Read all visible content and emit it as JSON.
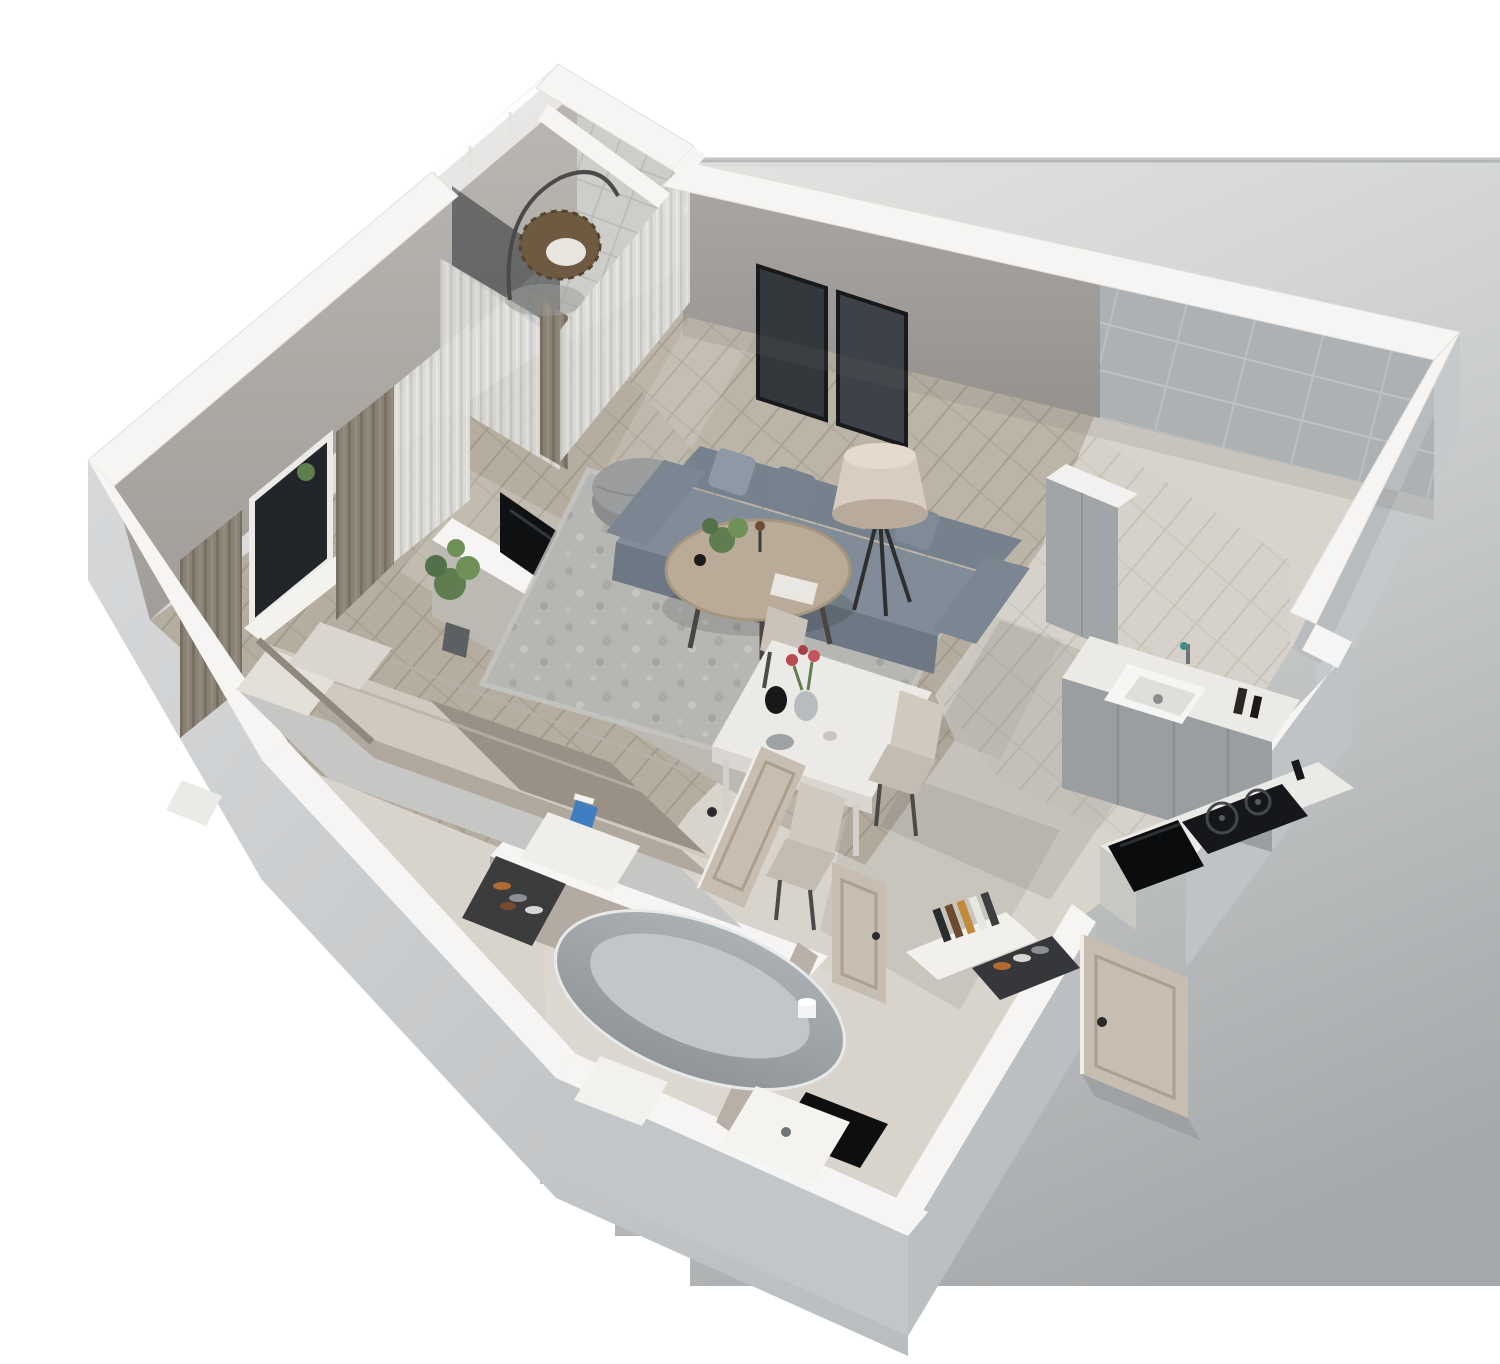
{
  "scene": {
    "title": "3D isometric cutaway floor plan render of a one-bedroom apartment",
    "type": "architectural-3d-floorplan",
    "view": "axonometric cutaway from above",
    "background_note": "white backdrop with large soft gray drop shadow cast to the lower right"
  },
  "palette": {
    "background": "#ffffff",
    "shadow_light": "#eceae8",
    "shadow_dark": "#a6a9ab",
    "shadow_edge_line": "#9aa0a3",
    "wall_cap": "#f6f5f3",
    "wall_exterior_light": "#d2d4d6",
    "wall_exterior_dark": "#bdc0c2",
    "wall_interior": "#b2aeaa",
    "feature_wall": "#9c9894",
    "wood_floor": "#bcb4a7",
    "bedroom_floor": "#b5ad9f",
    "kitchen_tile": "#d6d2c9",
    "stone_floor": "#dcd7cf",
    "balcony_tile": "#cdcec9",
    "rug": "#b6b6b3",
    "bed_rug": "#c6c7c5",
    "sofa": "#818c98",
    "sofa_dark": "#6d7884",
    "pillow": "#8e99a5",
    "coffee_table": "#b9ab97",
    "lamp_shade": "#d8cdc0",
    "dining_table": "#eceae6",
    "chair": "#cfc9c0",
    "counter": "#eceae6",
    "cabinet": "#9b9ea0",
    "backsplash": "#aeb1b3",
    "hob_black": "#16171a",
    "tv_black": "#101113",
    "door_wood": "#c7bdb0",
    "curtain_dark": "#8b8276",
    "curtain_sheer": "#dcdcd9",
    "bathtub": "#9fa5a8",
    "bath_mat": "#f2f1ee",
    "bedding": "#cfc9c0",
    "blanket": "#9a9186",
    "greenery": "#5f7d4f",
    "doormat_black": "#0d0e0e",
    "frame_art": "#33383c"
  },
  "rooms": [
    {
      "id": "bedroom",
      "name": "Bedroom",
      "furniture": [
        "double bed with taupe blanket and pillows",
        "area rug",
        "two curtained windows",
        "potted plant",
        "white dresser with blue box",
        "shoe rack with shoes",
        "small white nightstand"
      ]
    },
    {
      "id": "living-room",
      "name": "Living room",
      "furniture": [
        "gray fabric sofa with pillows",
        "round coffee table with plant",
        "gray pouf",
        "tripod floor lamp",
        "mottled gray rug",
        "two dark wall art frames",
        "wall-mounted TV on divider wall"
      ]
    },
    {
      "id": "balcony",
      "name": "Balcony",
      "furniture": [
        "rattan hanging chair",
        "tiled floor",
        "sheer curtains",
        "glass railing"
      ]
    },
    {
      "id": "kitchen",
      "name": "Kitchen",
      "furniture": [
        "gray cabinet run with white counter",
        "undermount sink with faucet",
        "tile backsplash",
        "induction hob",
        "black built-in appliance",
        "tall cabinet column"
      ]
    },
    {
      "id": "dining-area",
      "name": "Dining area",
      "furniture": [
        "white marble dining table",
        "three beige chairs",
        "vase with red tulips",
        "black jug",
        "bowl"
      ]
    },
    {
      "id": "hallway",
      "name": "Entry hallway",
      "furniture": [
        "white console with books",
        "shoe rack",
        "open entry door",
        "black doormat"
      ]
    },
    {
      "id": "bathroom",
      "name": "Bathroom",
      "furniture": [
        "freestanding gray oval bathtub",
        "white shower tray",
        "bath mat",
        "toilet paper roll",
        "open bathroom door",
        "stone walls"
      ]
    }
  ],
  "doors": [
    "bedroom door (open)",
    "bathroom door (open)",
    "entry door (open, swung outside)"
  ],
  "windows": [
    "bedroom window with dark curtains",
    "bedroom-balcony glazed wall with sheers",
    "balcony-living glazed wall with sheers"
  ]
}
